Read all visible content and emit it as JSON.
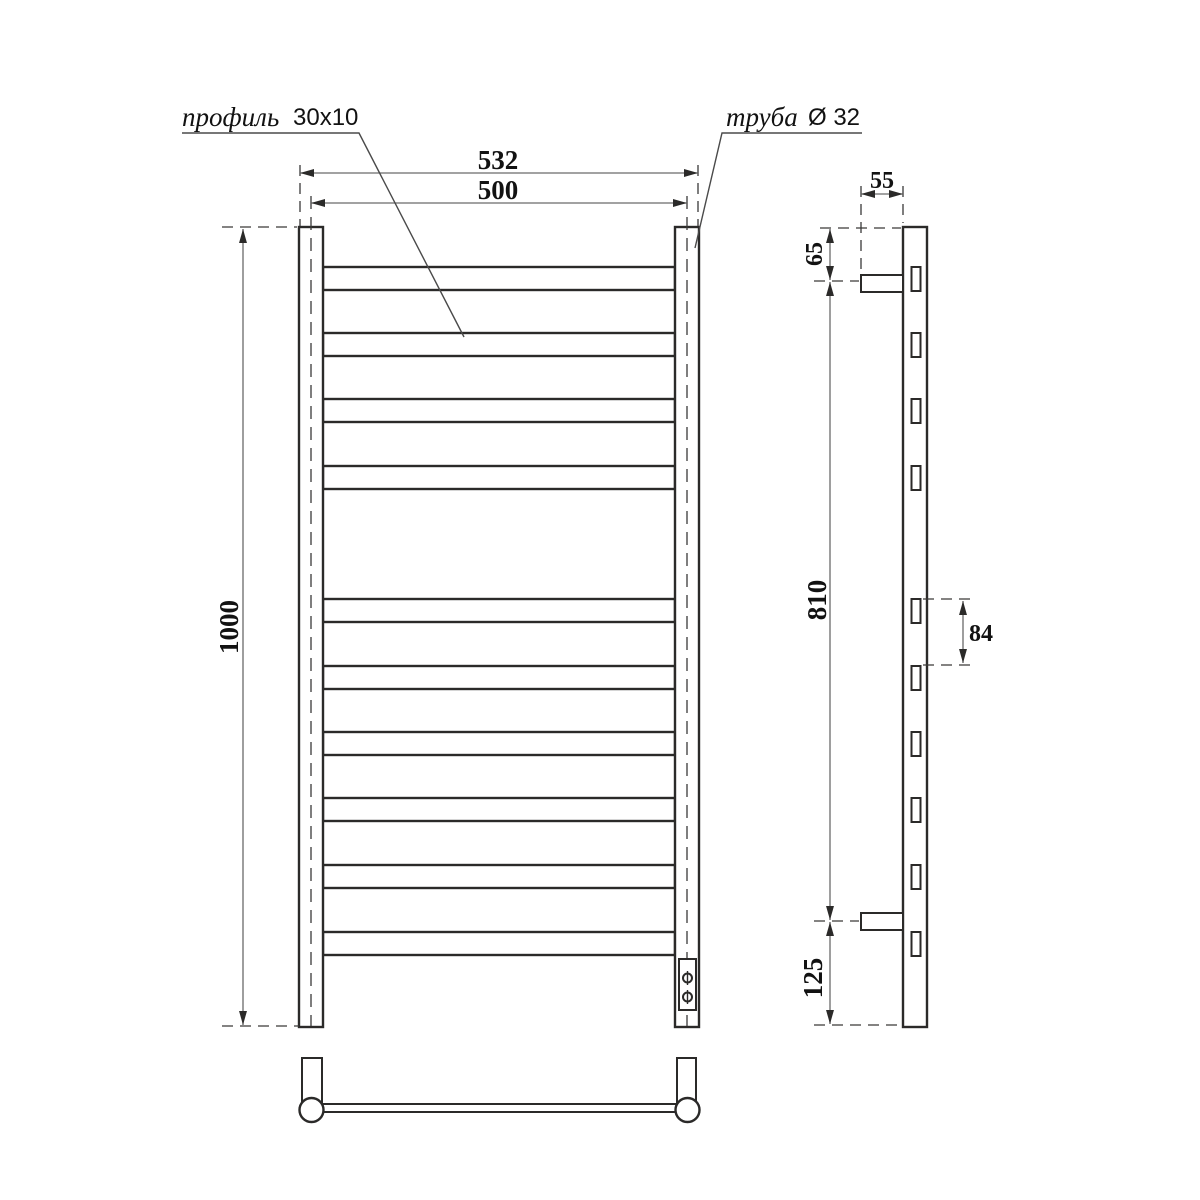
{
  "callouts": {
    "profile": {
      "name": "профиль",
      "size": "30x10"
    },
    "tube": {
      "name": "труба",
      "size": "Ø 32"
    }
  },
  "dimensions": {
    "front": {
      "overall_width_mm": "532",
      "center_width_mm": "500",
      "height_mm": "1000"
    },
    "side": {
      "bracket_length_mm": "55",
      "top_offset_mm": "65",
      "mount_span_mm": "810",
      "rung_pitch_mm": "84",
      "bottom_offset_mm": "125"
    }
  },
  "colors": {
    "outline": "#2b2a29",
    "dimension_line": "#6a6a6a",
    "text": "#121212",
    "background": "#ffffff"
  }
}
